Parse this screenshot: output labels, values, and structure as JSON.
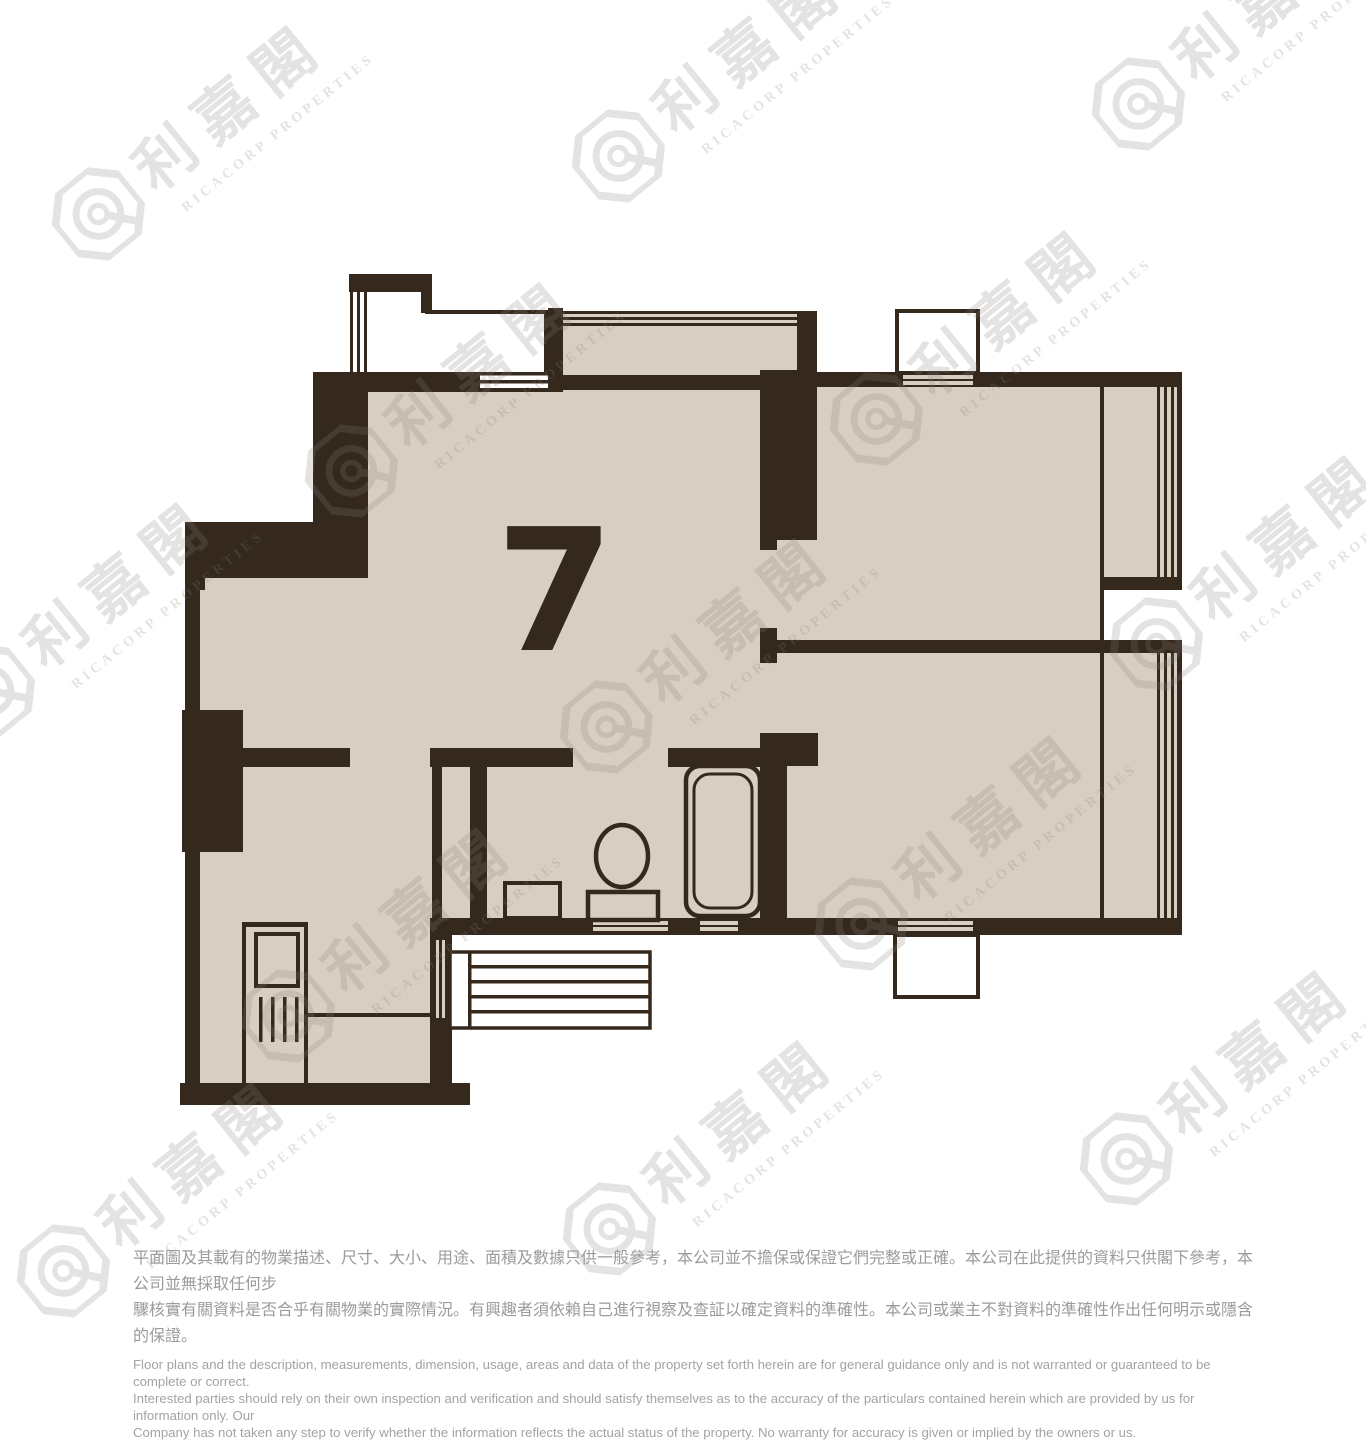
{
  "floor_plan": {
    "unit_label": "7"
  },
  "watermark": {
    "chinese": "利嘉閣",
    "english": "RICACORP PROPERTIES"
  },
  "disclaimer": {
    "zh": [
      "平面圖及其載有的物業描述、尺寸、大小、用途、面積及數據只供一般參考，本公司並不擔保或保證它們完整或正確。本公司在此提供的資料只供閣下參考，本公司並無採取任何步",
      "驟核實有關資料是否合乎有關物業的實際情況。有興趣者須依賴自己進行視察及查証以確定資料的準確性。本公司或業主不對資料的準確性作出任何明示或隱含的保證。"
    ],
    "en": [
      "Floor plans and the description, measurements, dimension, usage, areas and data of the property set forth herein are for general guidance only and is not warranted or guaranteed to be complete or correct.",
      "Interested parties should rely on their own inspection and verification and should satisfy themselves as to the accuracy of the particulars contained herein which are provided by us for information only.  Our",
      "Company has not taken any step to verify whether the information reflects the actual status of the property.  No warranty for accuracy is given or implied by the owners or us."
    ]
  },
  "colors": {
    "wall": "#35281d",
    "floor": "#d8cfc3",
    "watermark": "#8a837c",
    "disclaimer_zh": "#9b9b9b",
    "disclaimer_en": "#a3a3a3"
  }
}
